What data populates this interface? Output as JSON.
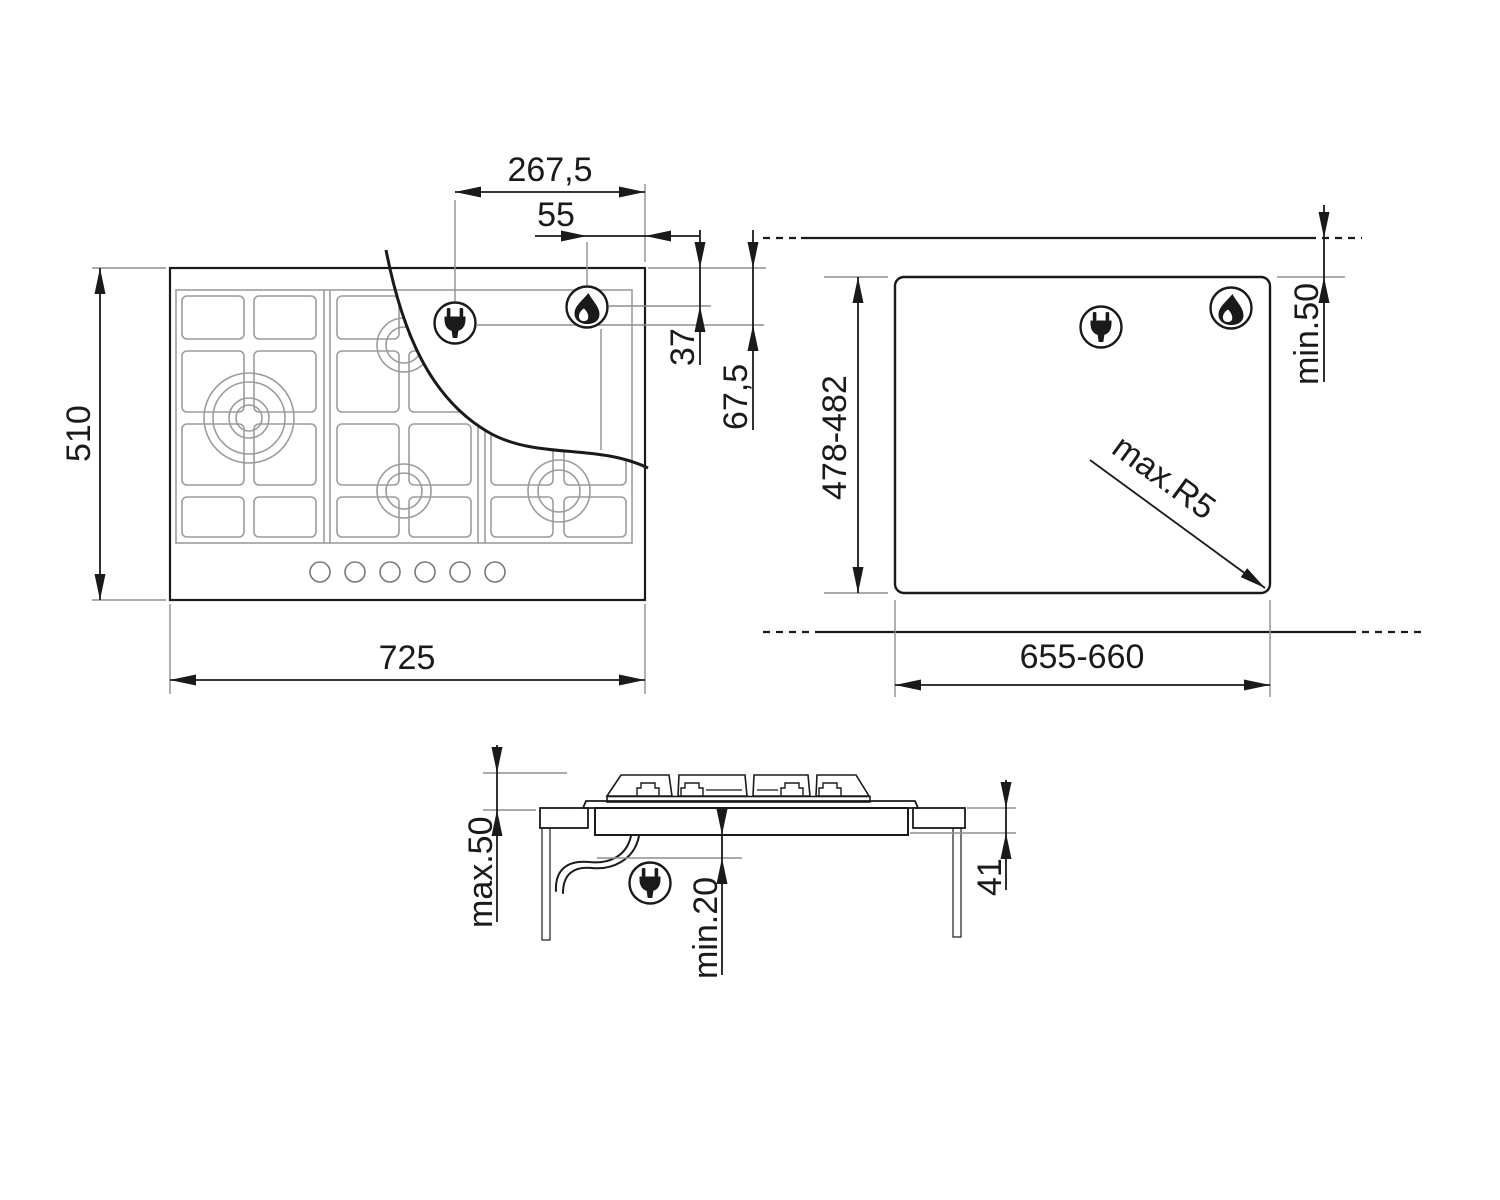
{
  "colors": {
    "ink": "#1a1a1a",
    "grid_gray": "#9c9c9c",
    "extension_gray": "#8f8f8f",
    "background": "#ffffff"
  },
  "top_view": {
    "width": "725",
    "height": "510",
    "electrical_offset_x": "267,5",
    "gas_offset_x": "55",
    "gas_offset_y": "37",
    "electrical_offset_y": "67,5"
  },
  "cutout_view": {
    "width": "655-660",
    "height": "478-482",
    "rear_clearance": "min.50",
    "corner_radius": "max.R5"
  },
  "side_view": {
    "clearance_above": "max.50",
    "clearance_below": "min.20",
    "recess_depth": "41"
  },
  "icons": {
    "plug": "power-plug-icon",
    "flame": "gas-flame-icon"
  }
}
